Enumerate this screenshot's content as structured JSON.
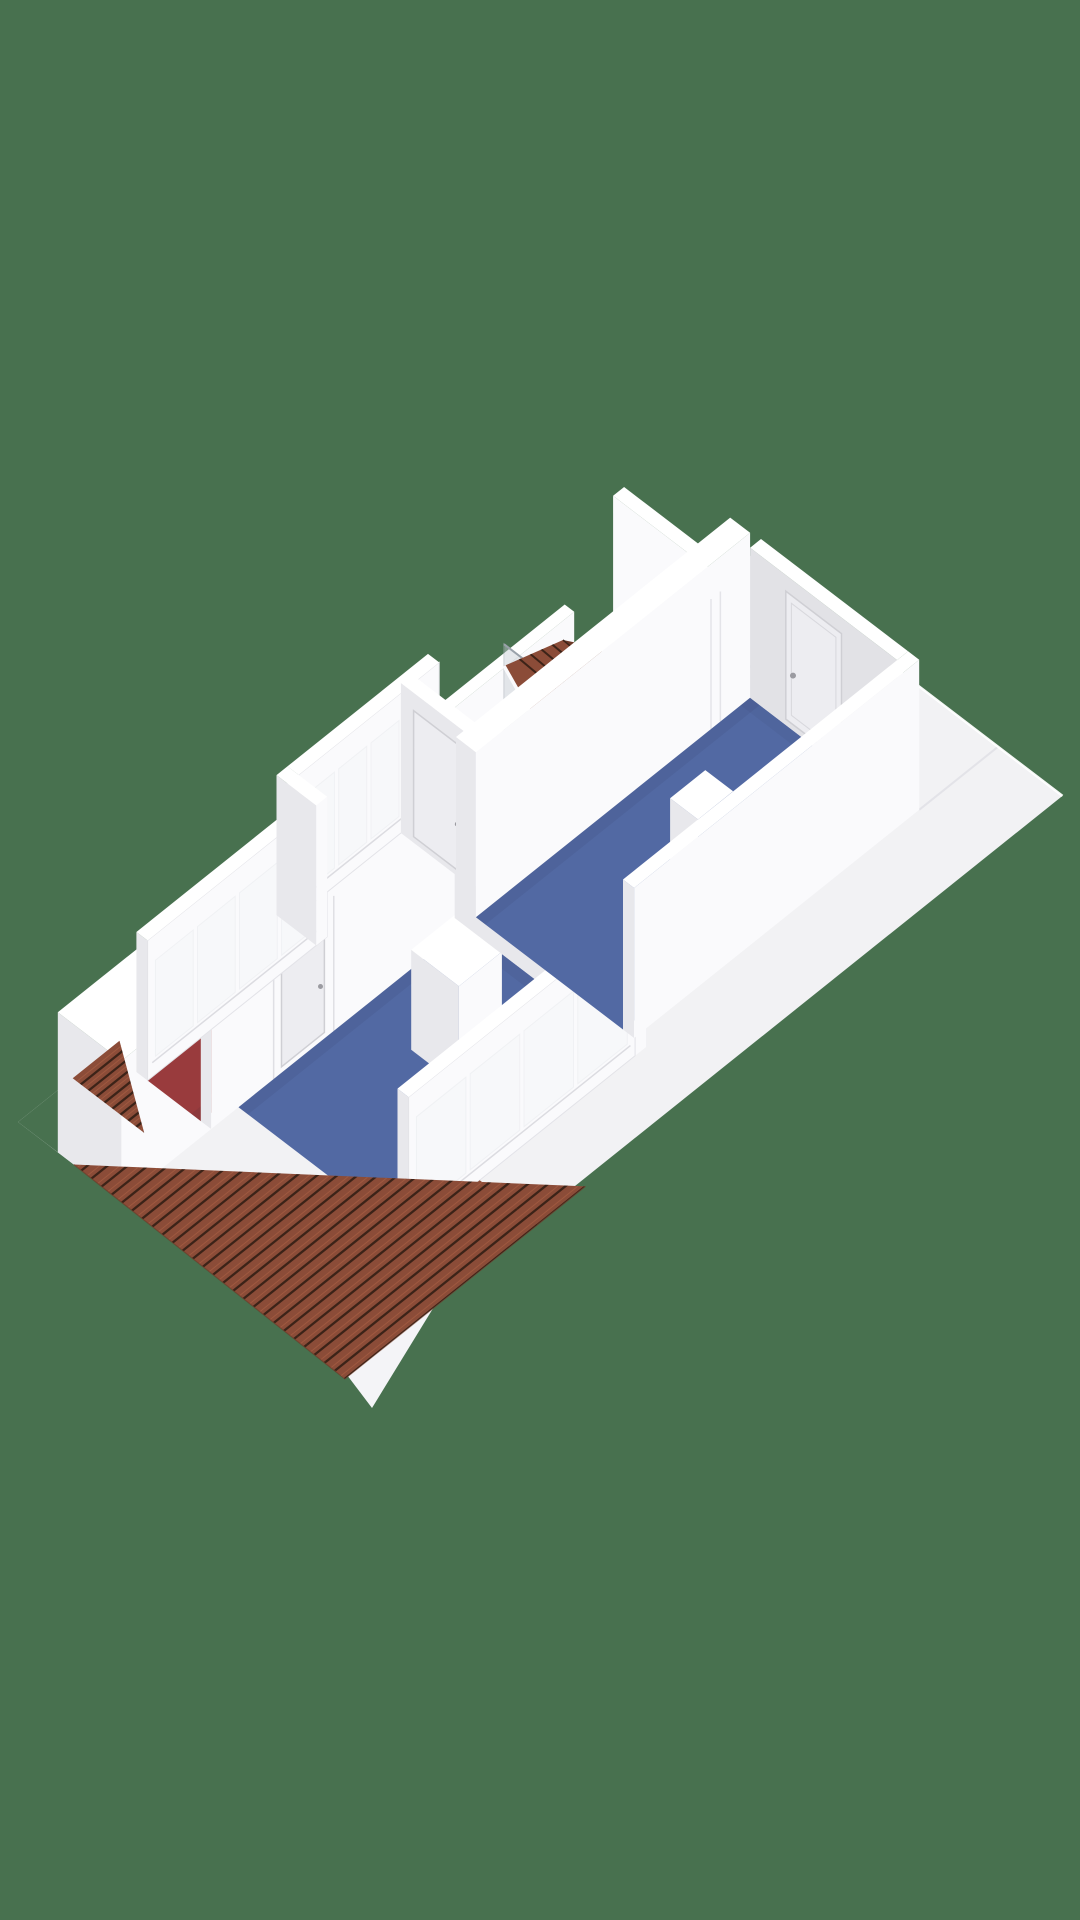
{
  "scene": {
    "kind": "3d-floorplan-render",
    "projection": "isometric",
    "visible_text": "",
    "background": "#48714F"
  },
  "colors": {
    "background": "#48714F",
    "flatRoof": "#F2F2F4",
    "roofSeam": "#E3E3E8",
    "fascia": "#F4F4F7",
    "wallTop": "#FFFFFF",
    "wallLight": "#FAFAFC",
    "wallShadow": "#E8E8EC",
    "wallInner": "#E2E2E6",
    "floorBlue": "#5269A3",
    "floorRed": "#993B3D",
    "tile": "#8B4C38",
    "tileDark": "#6B3927",
    "tileLine": "#3C2318",
    "tileLight": "#A35C42",
    "glass": "#F2F5F7",
    "screen": "#C6CDD4",
    "fixture": "#F6F6F8",
    "fixtureShade": "#E2E2E7",
    "basin": "#E8E8ED",
    "door": "#EDEDF1",
    "doorFrame": "#CFCFD4",
    "handle": "#9B9BA1",
    "vent": "#CDCDD2",
    "pipe": "#B5B5BA",
    "step": "#F3F3F5",
    "riser": "#E0E0E5",
    "shadow": "#23233A"
  },
  "rooms": [
    {
      "id": "hallway",
      "floor_color_key": "floorRed",
      "features": [
        "staircase",
        "stair-railing"
      ]
    },
    {
      "id": "bathroom",
      "floor_color_key": "floorBlue",
      "features": [
        "toilet",
        "cistern",
        "bathtub",
        "shower-screen",
        "dormer-roof",
        "door"
      ]
    },
    {
      "id": "bedroom-large",
      "floor_color_key": "floorBlue",
      "features": [
        "door",
        "wall-notch"
      ]
    },
    {
      "id": "bedroom-small",
      "floor_color_key": "floorBlue",
      "features": [
        "door",
        "closet",
        "window-band"
      ]
    }
  ],
  "exterior": {
    "flat_roof": true,
    "tiled_sloped_roof": true,
    "dormer": true,
    "roof_vent": true,
    "window_bands": 3
  }
}
